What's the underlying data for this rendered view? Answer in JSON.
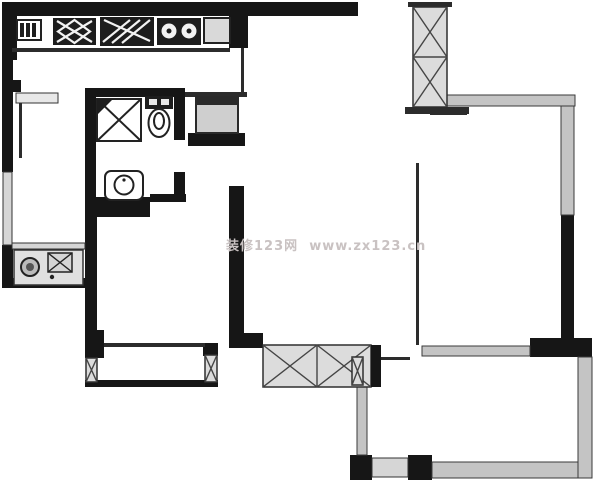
{
  "canvas": {
    "width": 600,
    "height": 489
  },
  "watermark": {
    "text": "装修123网  www.zx123.cn"
  },
  "colors": {
    "background": "#ffffff",
    "wall": "#161616",
    "wall_light_fill": "#c4c4c4",
    "wall_light_edge": "#3a3a3a",
    "hatch_fill": "#dcdcdc",
    "hatch_line": "#454545",
    "fixture_fill": "#d9d9d9",
    "fixture_line": "#222222",
    "partition_line": "#787878",
    "watermark_color": "#c9c2c2"
  },
  "fixtures": [
    "kitchen-cabinet-icon",
    "stove-icon",
    "dish-rack-icon",
    "double-sink-icon",
    "fridge-icon",
    "shower-icon",
    "toilet-icon",
    "washbasin-icon",
    "washer-icon",
    "utility-box-icon"
  ]
}
